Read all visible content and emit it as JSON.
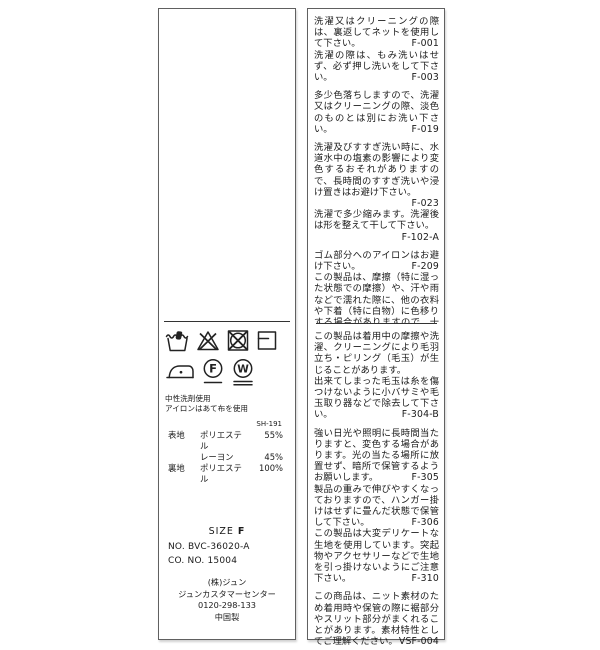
{
  "colors": {
    "background": "#ffffff",
    "border": "#606060",
    "text": "#1a1a1a"
  },
  "left_label": {
    "care_symbols_row1": [
      "hand-wash-icon",
      "do-not-bleach-icon",
      "do-not-tumble-dry-icon",
      "dry-flat-icon"
    ],
    "care_symbols_row2": [
      "iron-low-icon",
      "dry-clean-f-icon",
      "wet-clean-w-icon"
    ],
    "notes": [
      "中性洗剤使用",
      "アイロンはあて布を使用"
    ],
    "quality_code": "SH-191",
    "composition": [
      {
        "part": "表地",
        "material": "ポリエステル",
        "percent": "55%"
      },
      {
        "part": "",
        "material": "レーヨン",
        "percent": "45%"
      },
      {
        "part": "裏地",
        "material": "ポリエステル",
        "percent": "100%"
      }
    ],
    "size": {
      "label": "SIZE",
      "value": "F"
    },
    "numbers": [
      "NO. BVC-36020-A",
      "CO. NO.  15004"
    ],
    "company": [
      "(株)ジュン",
      "ジュンカスタマーセンター",
      "0120-298-133",
      "中国製"
    ]
  },
  "right_label": {
    "upper_paragraphs": [
      {
        "text": "洗濯又はクリーニングの際は、裏返してネットを使用して下さい。",
        "code": "F-001",
        "gap": false
      },
      {
        "text": "洗濯の際は、もみ洗いはせず、必ず押し洗いをして下さい。",
        "code": "F-003",
        "gap": true
      },
      {
        "text": "多少色落ちしますので、洗濯又はクリーニングの際、淡色のものとは別にお洗い下さい。",
        "code": "F-019",
        "gap": true
      },
      {
        "text": "洗濯及びすすぎ洗い時に、水道水中の塩素の影響により変色するおそれがありますので、長時間のすすぎ洗いや浸け置きはお避け下さい。",
        "code": "F-023",
        "gap": false
      },
      {
        "text": "洗濯で多少縮みます。洗濯後は形を整えて干して下さい。",
        "code": "F-102-A",
        "gap": true
      },
      {
        "text": "ゴム部分へのアイロンはお避け下さい。",
        "code": "F-209",
        "gap": false
      },
      {
        "text": "この製品は、摩擦（特に湿った状態での摩擦）や、汗や雨などで濡れた際に、他の衣料や下着（特に白物）に色移りする場合がありますので、十分ご注意下さい。",
        "code": "F-302",
        "gap": false
      }
    ],
    "lower_paragraphs": [
      {
        "text": "この製品は着用中の摩擦や洗濯、クリーニングにより毛羽立ち・ピリング（毛玉）が生じることがあります。",
        "code": "",
        "gap": false
      },
      {
        "text": "出来てしまった毛玉は糸を傷つけないように小バサミや毛玉取り器などで除去して下さい。",
        "code": "F-304-B",
        "gap": true
      },
      {
        "text": "強い日光や照明に長時間当たりますと、変色する場合があります。光の当たる場所に放置せず、暗所で保管するようお願いします。",
        "code": "F-305",
        "gap": false
      },
      {
        "text": "製品の重みで伸びやすくなっておりますので、ハンガー掛けはせずに畳んだ状態で保管して下さい。",
        "code": "F-306",
        "gap": false
      },
      {
        "text": "この製品は大変デリケートな生地を使用しています。突起物やアクセサリーなどで生地を引っ掛けないようにご注意下さい。",
        "code": "F-310",
        "gap": true
      },
      {
        "text": "この商品は、ニット素材のため着用時や保管の際に裾部分やスリット部分がまくれることがあります。素材特性としてご理解ください。",
        "code": "VSF-004",
        "gap": false
      }
    ]
  }
}
